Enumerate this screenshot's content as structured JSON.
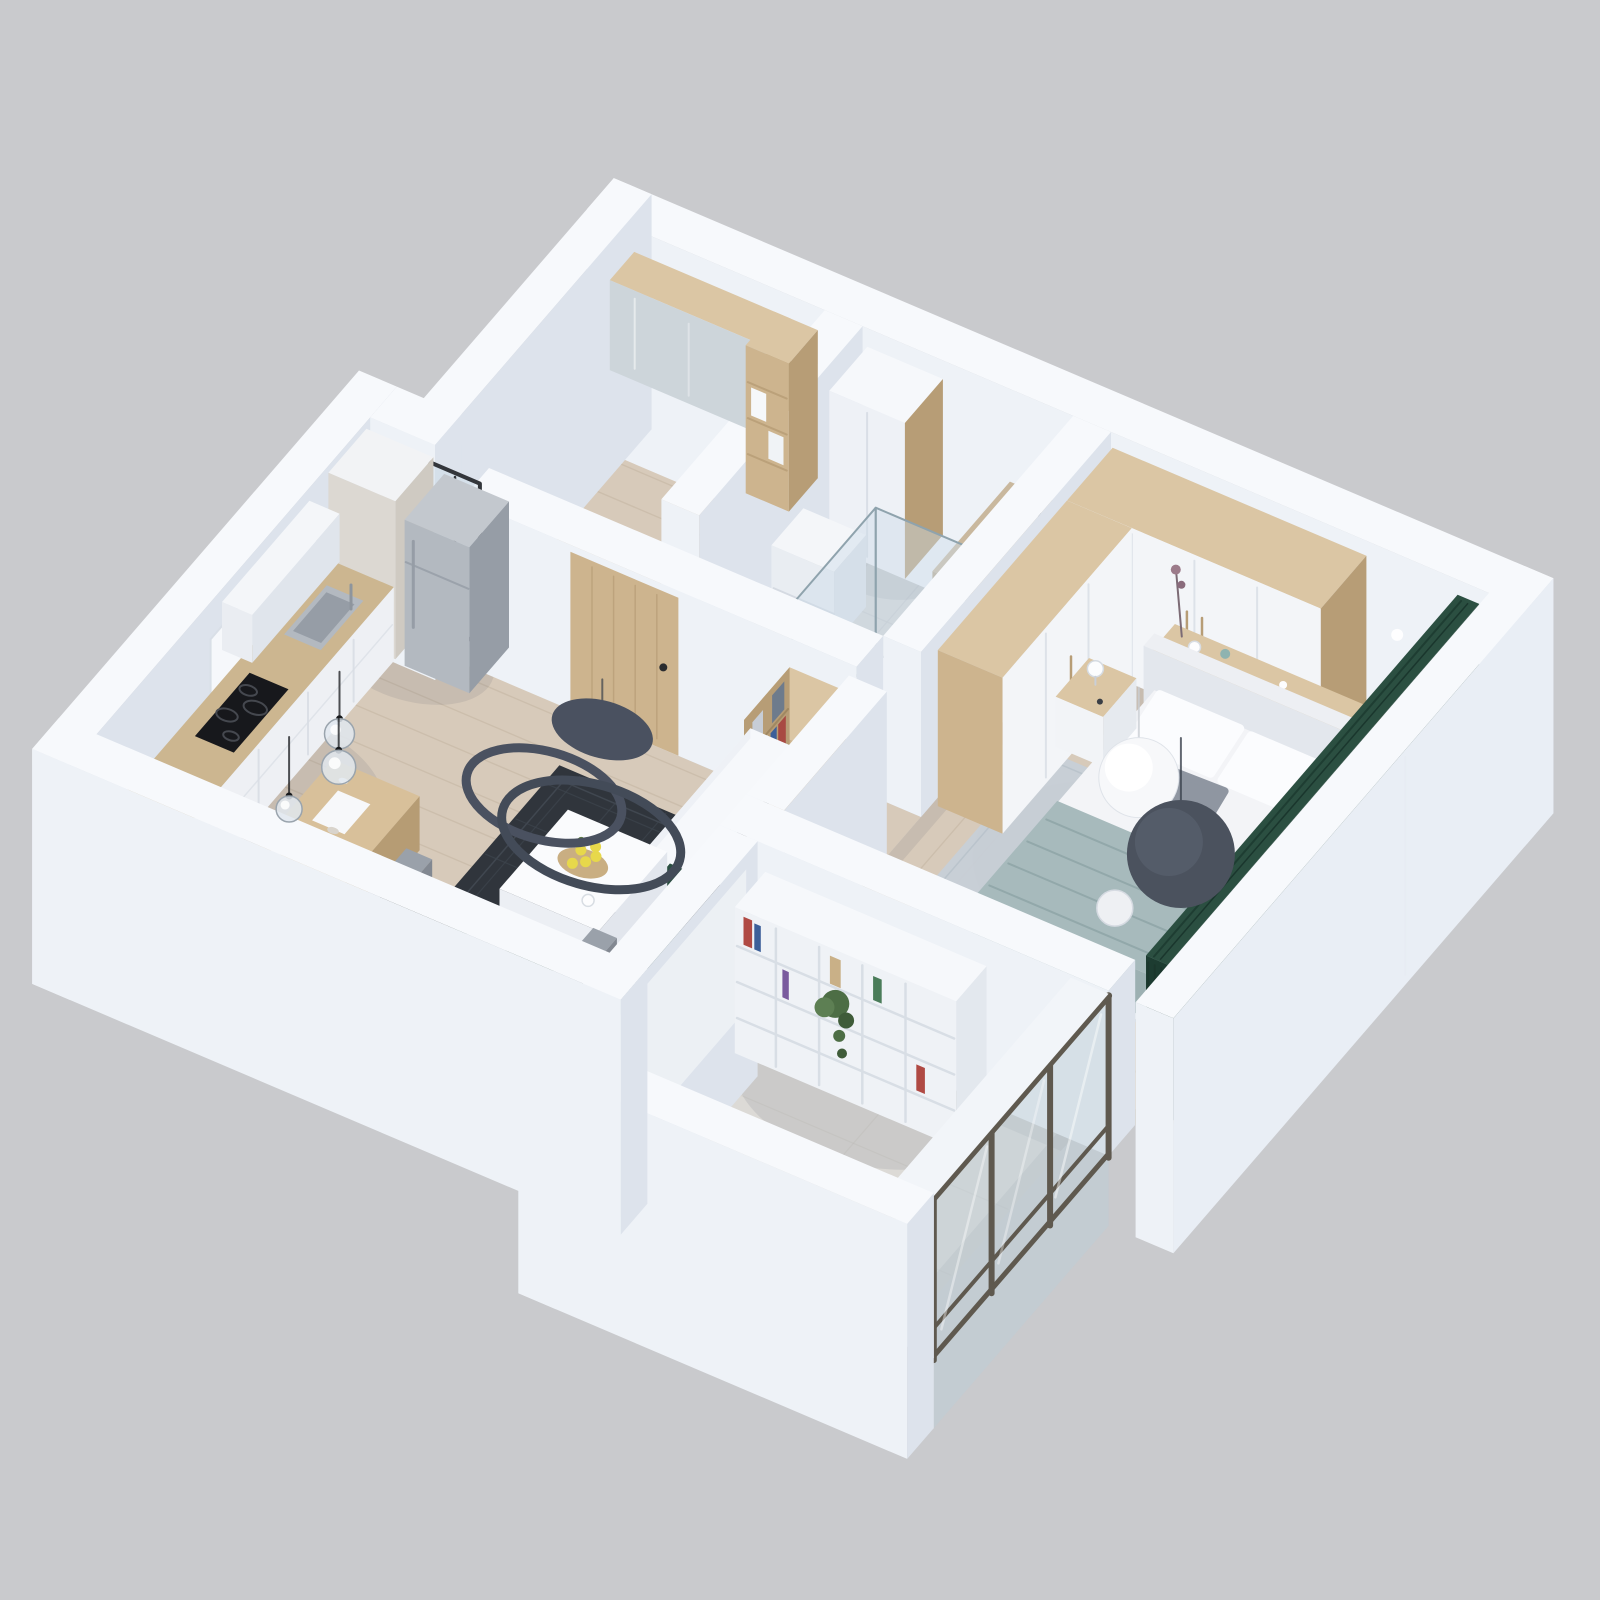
{
  "scene": {
    "type": "isometric-3d-floorplan-render",
    "style": "dollhouse cutaway of a one-bedroom apartment, white walls, scandinavian palette",
    "rooms": [
      {
        "id": "entry-hall",
        "floor": "wood",
        "furniture": [
          "wall-mounted-mirror-cabinet",
          "open-shelf-column",
          "wood-entry-door",
          "dark-framed-glass-door"
        ]
      },
      {
        "id": "bathroom",
        "floor": "gray-tile",
        "furniture": [
          "tall-white-cabinet",
          "low-white-unit",
          "walk-in-shower-glass",
          "wood-counter-with-black-round-basin"
        ]
      },
      {
        "id": "bedroom",
        "floor": "wood",
        "furniture": [
          "l-shaped-wardrobe-wood-and-white",
          "double-bed-white-bedding",
          "sage-blanket",
          "headboard-console-with-vases",
          "nightstand-left",
          "nightstand-right",
          "light-gray-rug",
          "sphere-pendant-white",
          "sphere-pendant-graphite",
          "floor-to-ceiling-green-curtains",
          "wall-downlights"
        ]
      },
      {
        "id": "kitchen-dining",
        "floor": "wood",
        "furniture": [
          "white-base-cabinets-wood-countertop",
          "stainless-sink",
          "black-induction-hob",
          "tall-column-cabinet",
          "stainless-fridge",
          "white-upper-cabinet",
          "wood-dining-table",
          "gray-shell-chairs",
          "glass-globe-pendants",
          "potted-plant",
          "west-wall-window"
        ]
      },
      {
        "id": "living-room",
        "floor": "wood",
        "furniture": [
          "dark-patterned-rug",
          "white-square-coffee-table",
          "wood-tray-with-lemons",
          "gray-sofa",
          "green-accent-pillows",
          "dark-throw-blanket",
          "tv-media-wall-wood-white",
          "bookshelf-tower-with-books",
          "black-tv-screen",
          "ring-chandelier",
          "green-curtain-panel"
        ]
      },
      {
        "id": "balcony",
        "floor": "stone",
        "furniture": [
          "white-cube-bookshelf",
          "colorful-books",
          "trailing-plant",
          "beige-armchair",
          "floor-to-ceiling-windows-dark-frames"
        ]
      }
    ]
  },
  "colors": {
    "background": "#c9cacd",
    "wall_top": "#f7f9fc",
    "wall_sw": "#eef2f7",
    "wall_se": "#dde3ec",
    "wall_outer": "#e9eef5",
    "floor_wood": "#d7caba",
    "floor_wood_line": "#c2b3a0",
    "floor_tile": "#d3d5d6",
    "floor_tile_line": "#c3c6c8",
    "floor_stone": "#dcdad6",
    "floor_stone_line": "#cdcac4",
    "rug_dark": "#30353c",
    "rug_dark_line": "#3e454e",
    "rug_light": "#c7cfd7",
    "wood": "#cdb48e",
    "wood_light": "#dbc6a4",
    "wood_dark": "#b79d76",
    "white_furn": "#f4f6f9",
    "steel": "#b3b9c0",
    "steel_dark": "#969da6",
    "hob_black": "#17181c",
    "glass": "rgba(205,220,232,0.45)",
    "glass_frame": "#8fa3ad",
    "window_frame": "#5f594f",
    "sofa": "#9aa1aa",
    "sofa_dark": "#8b929b",
    "pillow_green": "#3f5d4b",
    "throw_dark": "#252b22",
    "curtain_green": "#2b4f41",
    "curtain_green_dark": "#1d3c31",
    "bed_white": "#f3f4f7",
    "blanket": "#a7babc",
    "pillow_gray": "#8f96a1",
    "chair_gray": "#939aa3",
    "chair_gray_dark": "#7d838c",
    "lamp_dark": "#4a5160",
    "lemon": "#e7d84b",
    "plant": "#4d6e45",
    "tan_counter": "#c9b89e",
    "shadow": "rgba(60,70,90,0.10)"
  }
}
